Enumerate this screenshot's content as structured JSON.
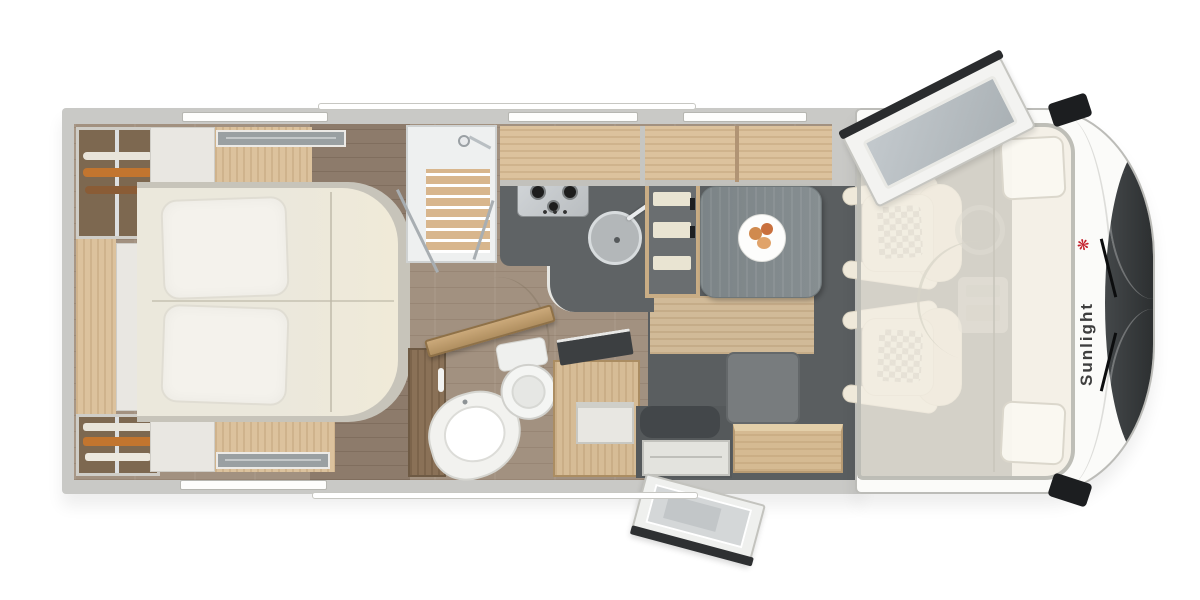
{
  "brand": {
    "logo_text": "Sunlight",
    "logo_text_color": "#3e3e3e",
    "logo_icon": "palm-icon",
    "logo_icon_glyph": "❋",
    "logo_icon_color": "#c4202b"
  },
  "palette": {
    "body_white": "#fbfbf9",
    "wall_gray": "#c9c9c6",
    "cabinet_wood": "#dcc29d",
    "floor_plank": "#a29180",
    "dinette_floor": "#5a5e60",
    "counter_charcoal": "#5f6365",
    "bed_cream": "#ece9dd",
    "seat_cream": "#efe9da",
    "windshield_dark": "#26292b"
  },
  "features": {
    "bedroom": [
      "wardrobe-hanging",
      "wardrobe-shelves",
      "island-bed",
      "pillows",
      "nightstands",
      "roof-vents"
    ],
    "bathroom": [
      "shower-cabin",
      "toilet",
      "corner-washbasin",
      "vanity-cabinet",
      "bathroom-door-open"
    ],
    "kitchen": [
      "three-burner-stove",
      "round-sink",
      "kitchen-counter",
      "refrigerator",
      "overhead-cabinets"
    ],
    "dinette": [
      "dining-table",
      "plate-of-food",
      "bench-seat",
      "sideboard"
    ],
    "cab": [
      "driver-seat",
      "passenger-seat",
      "drop-down-bed",
      "steering-wheel",
      "dashboard",
      "windshield",
      "side-mirror-top",
      "side-mirror-bottom",
      "cab-door-open"
    ],
    "entry": [
      "entry-door-open",
      "entry-step"
    ]
  }
}
